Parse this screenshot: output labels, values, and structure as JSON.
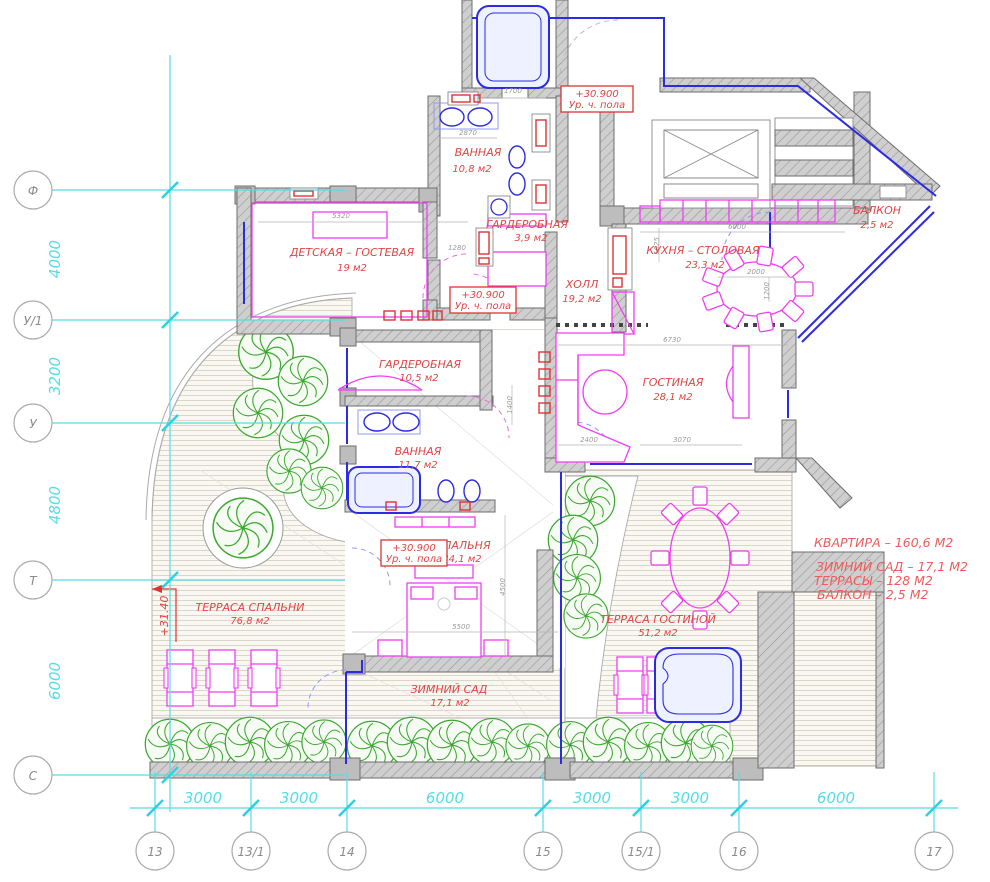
{
  "drawing": {
    "rooms": [
      {
        "name": "ВАННАЯ",
        "area": "10,8 м2"
      },
      {
        "name": "ГАРДЕРОБНАЯ",
        "area": "3,9 м2"
      },
      {
        "name": "ДЕТСКАЯ – ГОСТЕВАЯ",
        "area": "19 м2"
      },
      {
        "name": "ХОЛЛ",
        "area": "19,2 м2"
      },
      {
        "name": "КУХНЯ – СТОЛОВАЯ",
        "area": "23,3 м2"
      },
      {
        "name": "БАЛКОН",
        "area": "2,5 м2"
      },
      {
        "name": "ГОСТИНАЯ",
        "area": "28,1 м2"
      },
      {
        "name": "ГАРДЕРОБНАЯ",
        "area": "10,5 м2"
      },
      {
        "name": "ВАННАЯ",
        "area": "11,7 м2"
      },
      {
        "name": "СПАЛЬНЯ",
        "area": "34,1 м2"
      },
      {
        "name": "ТЕРРАСА СПАЛЬНИ",
        "area": "76,8 м2"
      },
      {
        "name": "ТЕРРАСА ГОСТИНОЙ",
        "area": "51,2 м2"
      },
      {
        "name": "ЗИМНИЙ САД",
        "area": "17,1 м2"
      }
    ],
    "level_marks": {
      "value": "+30.900",
      "caption": "Ур. ч. пола"
    },
    "elevation_mark": "+31.40",
    "summary": {
      "line1": "КВАРТИРА – 160,6 М2",
      "line2": "ЗИМНИЙ САД – 17,1 М2",
      "line3": "ТЕРРАСЫ – 128 М2",
      "line4": "БАЛКОН – 2,5 М2"
    },
    "grid": {
      "rows": [
        {
          "label": "Ф"
        },
        {
          "label": "У/1"
        },
        {
          "label": "У"
        },
        {
          "label": "Т"
        },
        {
          "label": "С"
        }
      ],
      "row_dims": [
        "4000",
        "3200",
        "4800",
        "6000"
      ],
      "cols": [
        {
          "label": "13"
        },
        {
          "label": "13/1"
        },
        {
          "label": "14"
        },
        {
          "label": "15"
        },
        {
          "label": "15/1"
        },
        {
          "label": "16"
        },
        {
          "label": "17"
        }
      ],
      "col_dims": [
        "3000",
        "3000",
        "6000",
        "3000",
        "3000",
        "6000"
      ]
    },
    "small_dims": [
      "1700",
      "2870",
      "5320",
      "1280",
      "6000",
      "1025",
      "2000",
      "1200",
      "6730",
      "2400",
      "3070",
      "5500",
      "4500",
      "1400"
    ],
    "colors": {
      "label_red": "#e04545",
      "furniture_magenta": "#f23cf2",
      "glazing_blue": "#2b2be0",
      "grid_cyan": "#55dce8",
      "tree_green": "#3aa82e",
      "wall_grey": "#cfcfcf"
    }
  }
}
